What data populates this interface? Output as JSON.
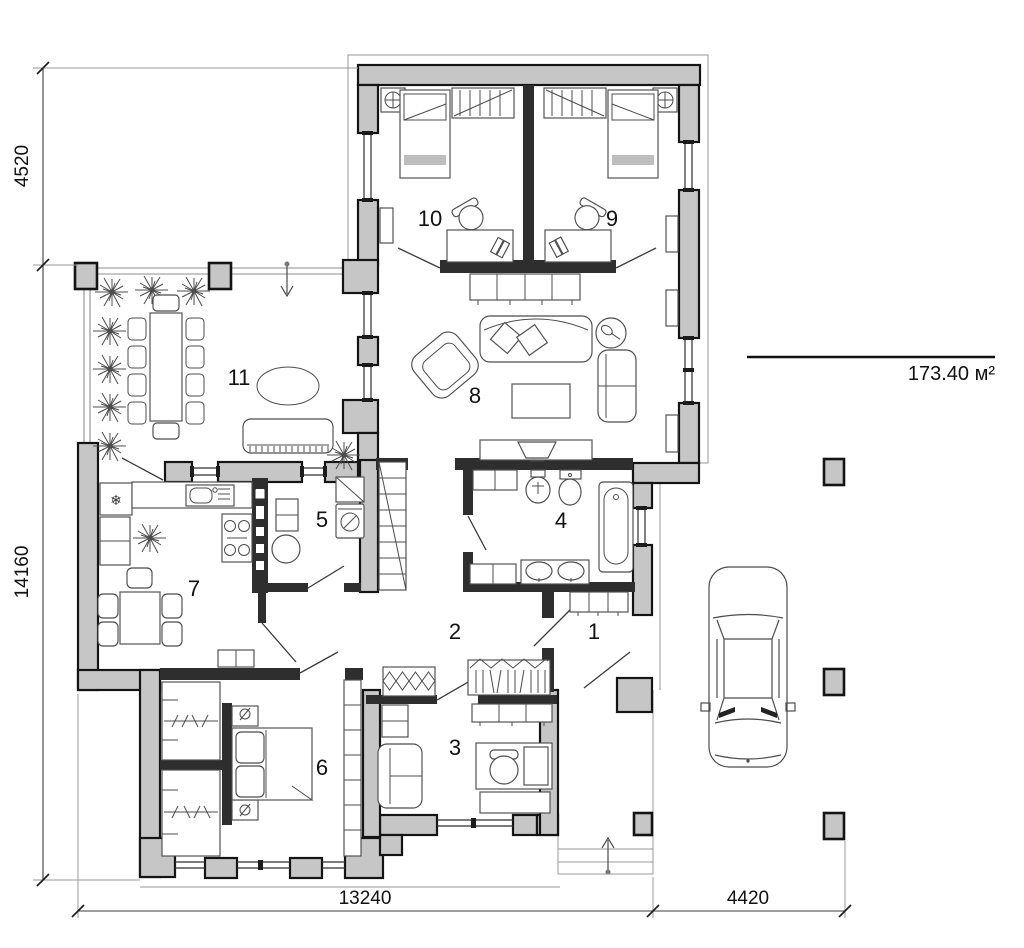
{
  "plan": {
    "title": "single-storey house floor plan",
    "area": {
      "value": "173.40 м²"
    },
    "dimensions": {
      "top_left_height": "4520",
      "left_height": "14160",
      "bottom_main_width": "13240",
      "bottom_right_width": "4420"
    },
    "rooms": [
      {
        "label": "1"
      },
      {
        "label": "2"
      },
      {
        "label": "3"
      },
      {
        "label": "4"
      },
      {
        "label": "5"
      },
      {
        "label": "6"
      },
      {
        "label": "7"
      },
      {
        "label": "8"
      },
      {
        "label": "9"
      },
      {
        "label": "10"
      },
      {
        "label": "11"
      }
    ],
    "icons": {
      "fridge_snowflake": "❄"
    }
  }
}
